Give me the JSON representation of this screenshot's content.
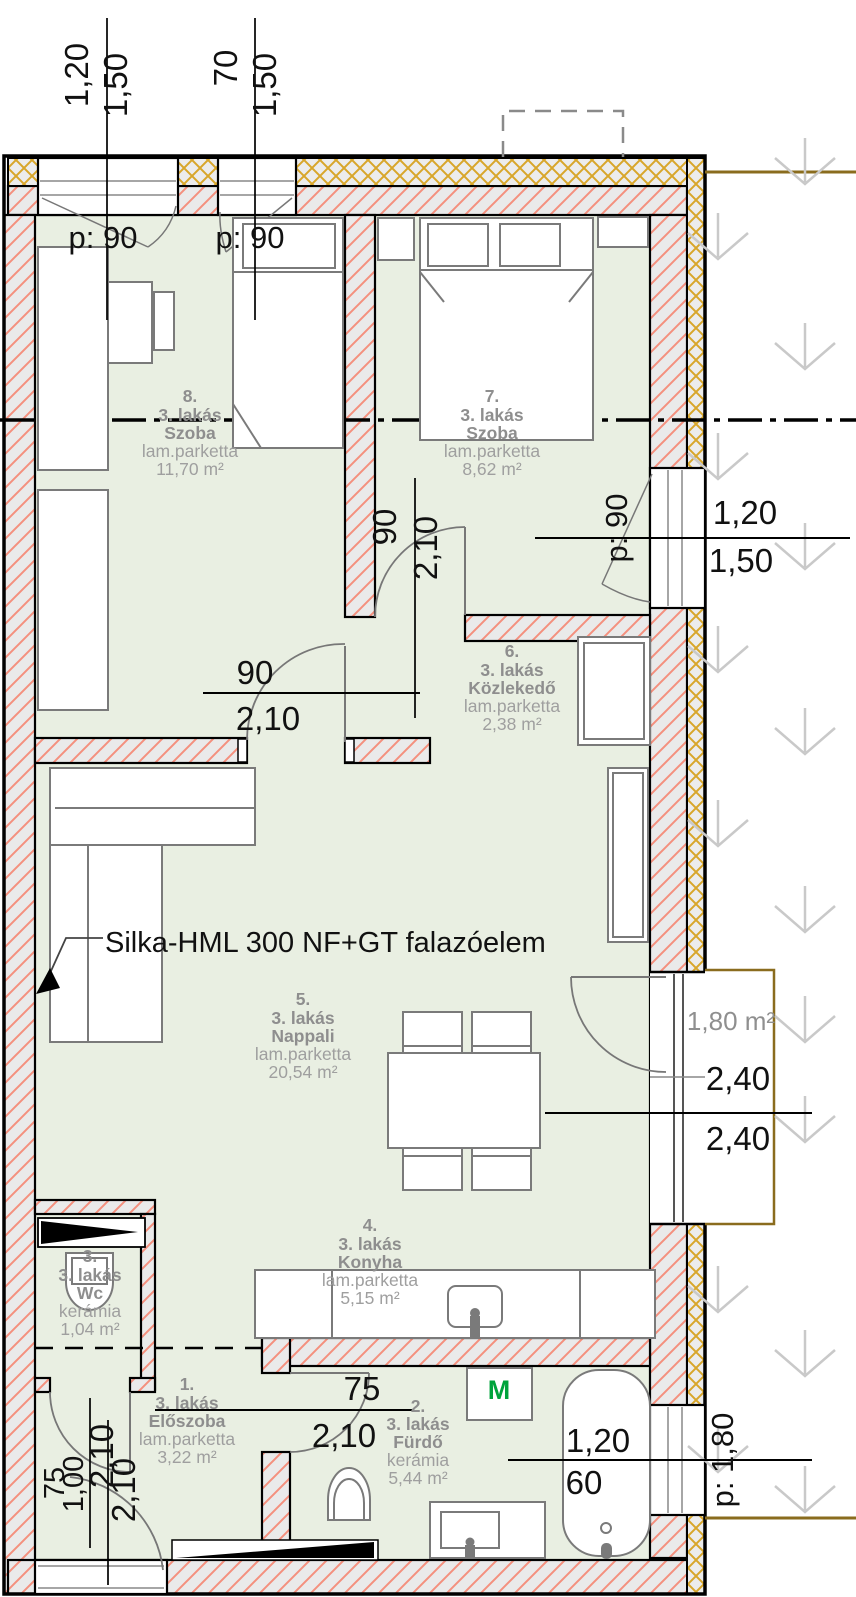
{
  "rooms": [
    {
      "number": "8.",
      "unit": "3. lakás",
      "name": "Szoba",
      "floor": "lam.parketta",
      "area": "11,70 m²"
    },
    {
      "number": "7.",
      "unit": "3. lakás",
      "name": "Szoba",
      "floor": "lam.parketta",
      "area": "8,62 m²"
    },
    {
      "number": "6.",
      "unit": "3. lakás",
      "name": "Közlekedő",
      "floor": "lam.parketta",
      "area": "2,38 m²"
    },
    {
      "number": "5.",
      "unit": "3. lakás",
      "name": "Nappali",
      "floor": "lam.parketta",
      "area": "20,54 m²"
    },
    {
      "number": "4.",
      "unit": "3. lakás",
      "name": "Konyha",
      "floor": "lam.parketta",
      "area": "5,15 m²"
    },
    {
      "number": "3.",
      "unit": "3. lakás",
      "name": "Wc",
      "floor": "kerámia",
      "area": "1,04 m²"
    },
    {
      "number": "1.",
      "unit": "3. lakás",
      "name": "Előszoba",
      "floor": "lam.parketta",
      "area": "3,22 m²"
    },
    {
      "number": "2.",
      "unit": "3. lakás",
      "name": "Fürdő",
      "floor": "kerámia",
      "area": "5,44 m²"
    }
  ],
  "dims": {
    "window_a": {
      "w": "1,20",
      "h": "1,50",
      "parapet": "p: 90"
    },
    "window_b": {
      "w": "70",
      "h": "1,50",
      "parapet": "p: 90"
    },
    "door_room8": {
      "w": "90",
      "h": "2,10"
    },
    "door_room7": {
      "w": "90",
      "h": "2,10"
    },
    "window_room7": {
      "w": "1,20",
      "h": "1,50",
      "parapet": "p: 90"
    },
    "balcony_door": {
      "w": "2,40",
      "h": "2,40"
    },
    "balcony_area": "1,80 m²",
    "door_bath": {
      "w": "75",
      "h": "2,10"
    },
    "door_wc": {
      "w": "75",
      "h": "2,10"
    },
    "door_entry": {
      "w": "1,00",
      "h": "2,10"
    },
    "window_bath": {
      "w": "1,20",
      "h": "60",
      "parapet": "p: 1,80"
    }
  },
  "annotations": {
    "wall_note": "Silka-HML 300 NF+GT falazóelem",
    "washing_machine": "M"
  },
  "colors": {
    "room_fill": "#e9efe2",
    "wall_fill": "#eaeaea",
    "brick_hatch": "#f4907e",
    "insulation_hatch": "#d8a62a",
    "terrain_line": "#8a6c1e",
    "label_gray": "#909090",
    "dim_black": "#111111",
    "washing_machine_green": "#00a33c",
    "furniture_stroke": "#7a7a7a"
  }
}
